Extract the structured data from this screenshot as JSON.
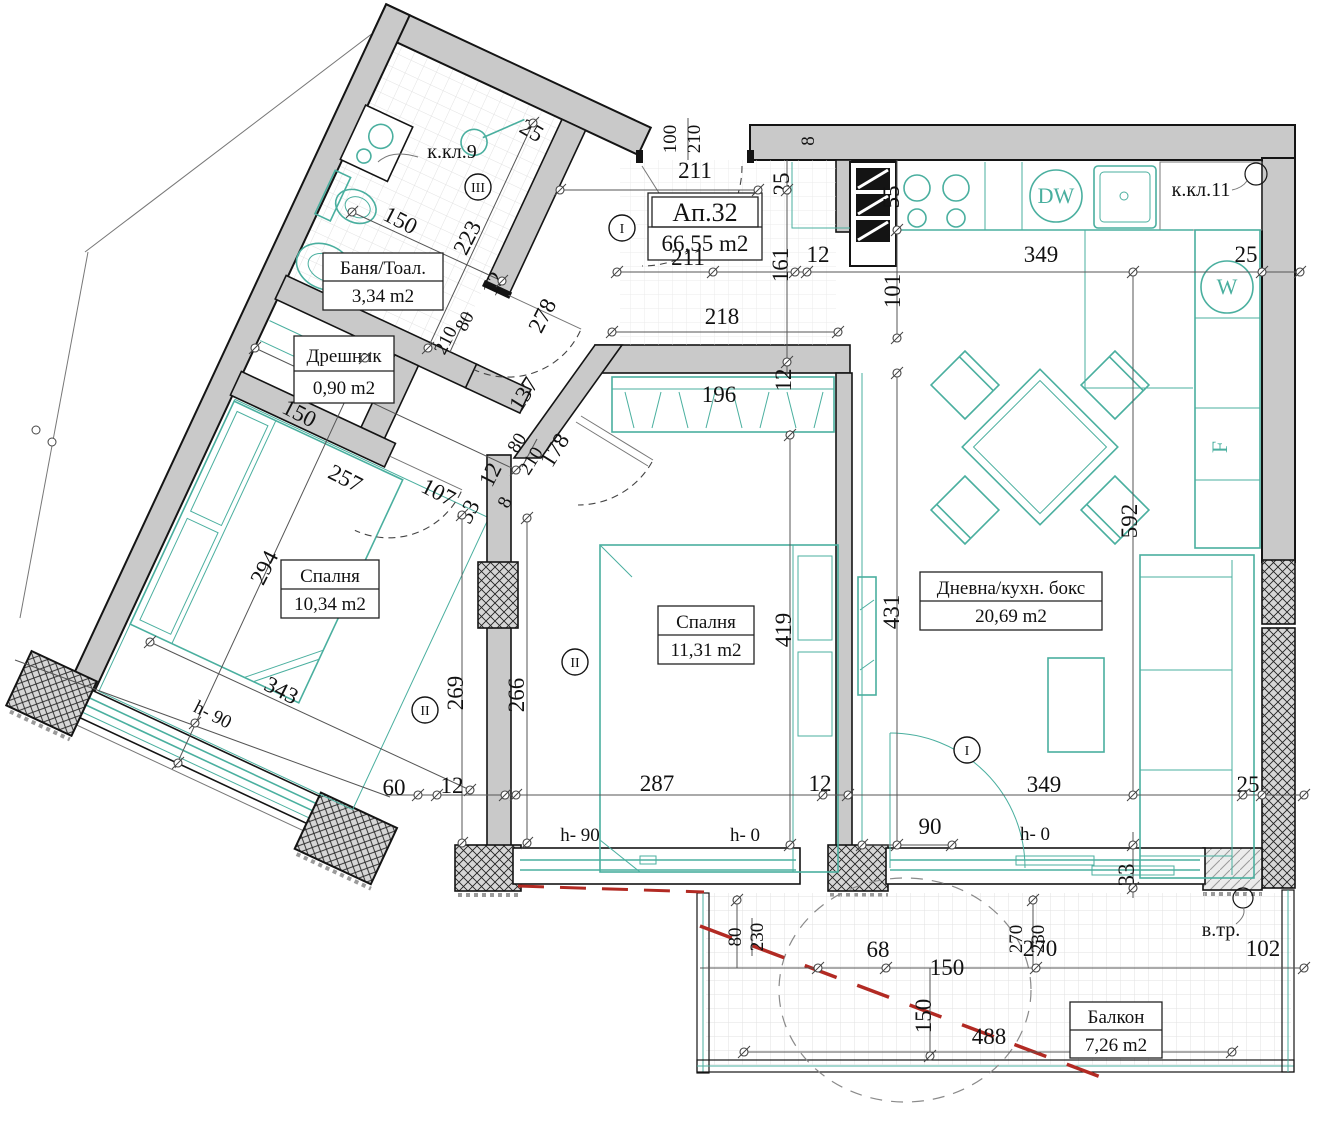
{
  "plan": {
    "apartment": {
      "label": "Ап.32",
      "area": "66,55 m2"
    },
    "rooms": [
      {
        "id": "bathroom",
        "name": "Баня/Тоал.",
        "area": "3,34 m2"
      },
      {
        "id": "closet",
        "name": "Дрешник",
        "area": "0,90 m2"
      },
      {
        "id": "bedroom1",
        "name": "Спалня",
        "area": "10,34 m2"
      },
      {
        "id": "bedroom2",
        "name": "Спалня",
        "area": "11,31 m2"
      },
      {
        "id": "living",
        "name": "Дневна/кухн. бокс",
        "area": "20,69 m2"
      },
      {
        "id": "balcony",
        "name": "Балкон",
        "area": "7,26 m2"
      }
    ],
    "appliances": {
      "dishwasher": "DW",
      "washer": "W",
      "fridge": "F"
    },
    "shafts": {
      "k9": "к.кл.9",
      "k11": "к.кл.11",
      "vtr": "в.тр."
    },
    "axis_markers": [
      {
        "label": "I",
        "x": 622,
        "y": 228
      },
      {
        "label": "I",
        "x": 967,
        "y": 750
      },
      {
        "label": "II",
        "x": 425,
        "y": 710
      },
      {
        "label": "II",
        "x": 575,
        "y": 662
      },
      {
        "label": "III",
        "x": 478,
        "y": 187
      }
    ],
    "colors": {
      "wall_fill": "#c9c9c9",
      "furniture_teal": "#4aaf9f",
      "red_dashed": "#b22a23"
    },
    "dim_labels": [
      {
        "t": "211",
        "x": 695,
        "y": 178,
        "r": 0
      },
      {
        "t": "211",
        "x": 688,
        "y": 265,
        "r": 0
      },
      {
        "t": "100",
        "x": 676,
        "y": 139,
        "r": -90,
        "s": 19
      },
      {
        "t": "210",
        "x": 700,
        "y": 139,
        "r": -90,
        "s": 19
      },
      {
        "t": "25",
        "x": 789,
        "y": 184,
        "r": -90
      },
      {
        "t": "8",
        "x": 814,
        "y": 141,
        "r": -90,
        "s": 20
      },
      {
        "t": "55",
        "x": 899,
        "y": 197,
        "r": -90
      },
      {
        "t": "161",
        "x": 788,
        "y": 265,
        "r": -90
      },
      {
        "t": "12",
        "x": 818,
        "y": 262,
        "r": 0
      },
      {
        "t": "101",
        "x": 900,
        "y": 291,
        "r": -90
      },
      {
        "t": "349",
        "x": 1041,
        "y": 262,
        "r": 0
      },
      {
        "t": "25",
        "x": 1246,
        "y": 262,
        "r": 0
      },
      {
        "t": "25",
        "x": 528,
        "y": 137,
        "r": 30
      },
      {
        "t": "150",
        "x": 397,
        "y": 227,
        "r": 27
      },
      {
        "t": "223",
        "x": 474,
        "y": 241,
        "r": -63
      },
      {
        "t": "12",
        "x": 500,
        "y": 287,
        "r": -63
      },
      {
        "t": "278",
        "x": 549,
        "y": 319,
        "r": -63
      },
      {
        "t": "80",
        "x": 470,
        "y": 324,
        "r": -63,
        "s": 19
      },
      {
        "t": "210",
        "x": 451,
        "y": 343,
        "r": -63,
        "s": 19
      },
      {
        "t": "150",
        "x": 296,
        "y": 420,
        "r": 27
      },
      {
        "t": "257",
        "x": 342,
        "y": 485,
        "r": 27
      },
      {
        "t": "107",
        "x": 435,
        "y": 499,
        "r": 27
      },
      {
        "t": "33",
        "x": 475,
        "y": 515,
        "r": -63
      },
      {
        "t": "12",
        "x": 497,
        "y": 478,
        "r": -63
      },
      {
        "t": "8",
        "x": 510,
        "y": 505,
        "r": -63,
        "s": 18
      },
      {
        "t": "80",
        "x": 522,
        "y": 446,
        "r": -58,
        "s": 19
      },
      {
        "t": "210",
        "x": 536,
        "y": 464,
        "r": -58,
        "s": 19
      },
      {
        "t": "178",
        "x": 561,
        "y": 454,
        "r": -58
      },
      {
        "t": "137",
        "x": 530,
        "y": 398,
        "r": -58
      },
      {
        "t": "294",
        "x": 271,
        "y": 571,
        "r": -63
      },
      {
        "t": "343",
        "x": 278,
        "y": 697,
        "r": 27
      },
      {
        "t": "h- 90",
        "x": 210,
        "y": 720,
        "r": 27,
        "s": 19
      },
      {
        "t": "269",
        "x": 463,
        "y": 693,
        "r": -90
      },
      {
        "t": "266",
        "x": 524,
        "y": 695,
        "r": -90
      },
      {
        "t": "218",
        "x": 722,
        "y": 324,
        "r": 0
      },
      {
        "t": "196",
        "x": 719,
        "y": 402,
        "r": 0
      },
      {
        "t": "12",
        "x": 791,
        "y": 380,
        "r": -90
      },
      {
        "t": "419",
        "x": 791,
        "y": 630,
        "r": -90
      },
      {
        "t": "431",
        "x": 899,
        "y": 612,
        "r": -90
      },
      {
        "t": "592",
        "x": 1137,
        "y": 521,
        "r": -90
      },
      {
        "t": "60",
        "x": 394,
        "y": 795,
        "r": 0
      },
      {
        "t": "12",
        "x": 452,
        "y": 793,
        "r": 0
      },
      {
        "t": "287",
        "x": 657,
        "y": 791,
        "r": 0
      },
      {
        "t": "12",
        "x": 820,
        "y": 791,
        "r": 0
      },
      {
        "t": "349",
        "x": 1044,
        "y": 792,
        "r": 0
      },
      {
        "t": "25",
        "x": 1248,
        "y": 792,
        "r": 0
      },
      {
        "t": "h- 90",
        "x": 580,
        "y": 841,
        "r": 0,
        "s": 19
      },
      {
        "t": "h- 0",
        "x": 745,
        "y": 841,
        "r": 0,
        "s": 19
      },
      {
        "t": "90",
        "x": 930,
        "y": 834,
        "r": 0
      },
      {
        "t": "h- 0",
        "x": 1035,
        "y": 840,
        "r": 0,
        "s": 19
      },
      {
        "t": "33",
        "x": 1134,
        "y": 875,
        "r": -90
      },
      {
        "t": "80",
        "x": 741,
        "y": 937,
        "r": -90,
        "s": 19
      },
      {
        "t": "230",
        "x": 763,
        "y": 937,
        "r": -90,
        "s": 19
      },
      {
        "t": "270",
        "x": 1022,
        "y": 939,
        "r": -90,
        "s": 19
      },
      {
        "t": "230",
        "x": 1044,
        "y": 939,
        "r": -90,
        "s": 19
      },
      {
        "t": "68",
        "x": 878,
        "y": 957,
        "r": 0
      },
      {
        "t": "150",
        "x": 947,
        "y": 975,
        "r": 0
      },
      {
        "t": "150",
        "x": 931,
        "y": 1016,
        "r": -90
      },
      {
        "t": "270",
        "x": 1040,
        "y": 956,
        "r": 0
      },
      {
        "t": "102",
        "x": 1263,
        "y": 956,
        "r": 0
      },
      {
        "t": "488",
        "x": 989,
        "y": 1044,
        "r": 0
      }
    ]
  }
}
